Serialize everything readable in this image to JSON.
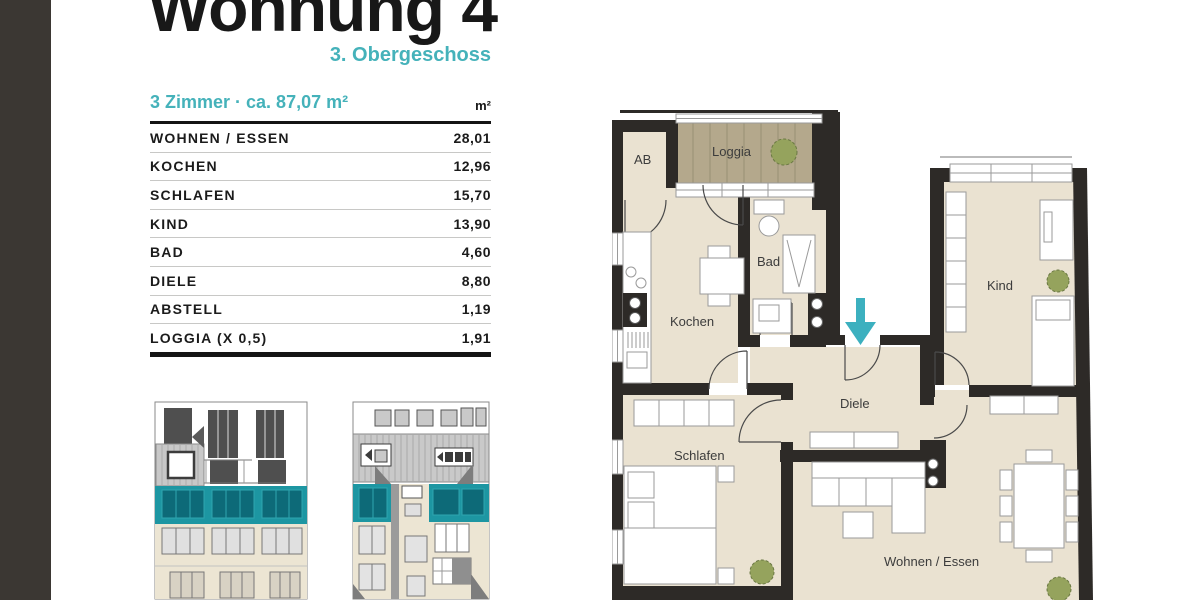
{
  "header": {
    "title": "Wohnung 4",
    "subtitle": "3. Obergeschoss"
  },
  "area_table": {
    "caption": "3 Zimmer · ca. 87,07 m²",
    "unit_column": "m²",
    "rows": [
      {
        "label": "WOHNEN / ESSEN",
        "value": "28,01"
      },
      {
        "label": "KOCHEN",
        "value": "12,96"
      },
      {
        "label": "SCHLAFEN",
        "value": "15,70"
      },
      {
        "label": "KIND",
        "value": "13,90"
      },
      {
        "label": "BAD",
        "value": "4,60"
      },
      {
        "label": "DIELE",
        "value": "8,80"
      },
      {
        "label": "ABSTELL",
        "value": "1,19"
      },
      {
        "label": "LOGGIA (X 0,5)",
        "value": "1,91"
      }
    ]
  },
  "floorplan": {
    "labels": {
      "ab": "AB",
      "loggia": "Loggia",
      "bad": "Bad",
      "kochen": "Kochen",
      "kind": "Kind",
      "diele": "Diele",
      "schlafen": "Schlafen",
      "wohnen": "Wohnen / Essen"
    },
    "entrance_marker": "entrance-arrow-down"
  },
  "colors": {
    "accent_teal": "#45b2ba",
    "elevation_teal": "#1d96a2",
    "window_teal_dark": "#0d6a78",
    "floor_beige": "#eae2d1",
    "loggia_deck": "#b4a88c",
    "wall_dark": "#2d2a27",
    "sidebar_dark": "#3b3733",
    "arrow_teal": "#3cb0bf"
  }
}
